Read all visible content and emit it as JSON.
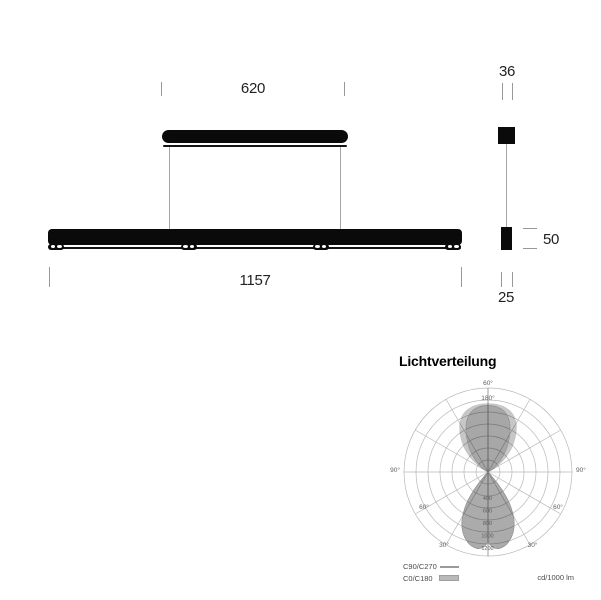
{
  "drawing": {
    "front": {
      "width_canopy": "620",
      "width_bar": "1157"
    },
    "side": {
      "dim_top": "36",
      "dim_height": "50",
      "dim_bottom": "25"
    }
  },
  "chart": {
    "title": "Lichtverteilung",
    "unit_label": "cd/1000 lm",
    "legend": {
      "line_series": "C90/C270",
      "filled_series": "C0/C180"
    },
    "angles": {
      "top_outer": "60°",
      "top_inner": "180°",
      "left": "90°",
      "right": "90°",
      "mid_left": "60°",
      "mid_right": "60°",
      "low_left": "30°",
      "low_right": "30°"
    },
    "rings": [
      "400",
      "600",
      "800",
      "1000",
      "1200"
    ]
  },
  "chart_data": {
    "type": "polar",
    "title": "Lichtverteilung",
    "unit": "cd/1000 lm",
    "radial_axis": {
      "min": 0,
      "max": 1400,
      "step": 200,
      "labeled_ticks": [
        400,
        600,
        800,
        1000,
        1200
      ]
    },
    "angle_ticks_deg": [
      0,
      30,
      60,
      90,
      120,
      150,
      180
    ],
    "gamma_deg": [
      0,
      15,
      30,
      45,
      60,
      75,
      90,
      105,
      120,
      135,
      150,
      165,
      180
    ],
    "series": [
      {
        "name": "C90/C270",
        "style": "line",
        "values_cd_per_1000lm": [
          1230,
          1300,
          900,
          480,
          170,
          40,
          10,
          50,
          220,
          560,
          950,
          1140,
          1150
        ]
      },
      {
        "name": "C0/C180",
        "style": "filled_area",
        "values_cd_per_1000lm": [
          1230,
          1290,
          920,
          500,
          190,
          50,
          15,
          70,
          300,
          650,
          1000,
          1150,
          1160
        ]
      }
    ],
    "grid": true,
    "legend_position": "bottom-left"
  }
}
